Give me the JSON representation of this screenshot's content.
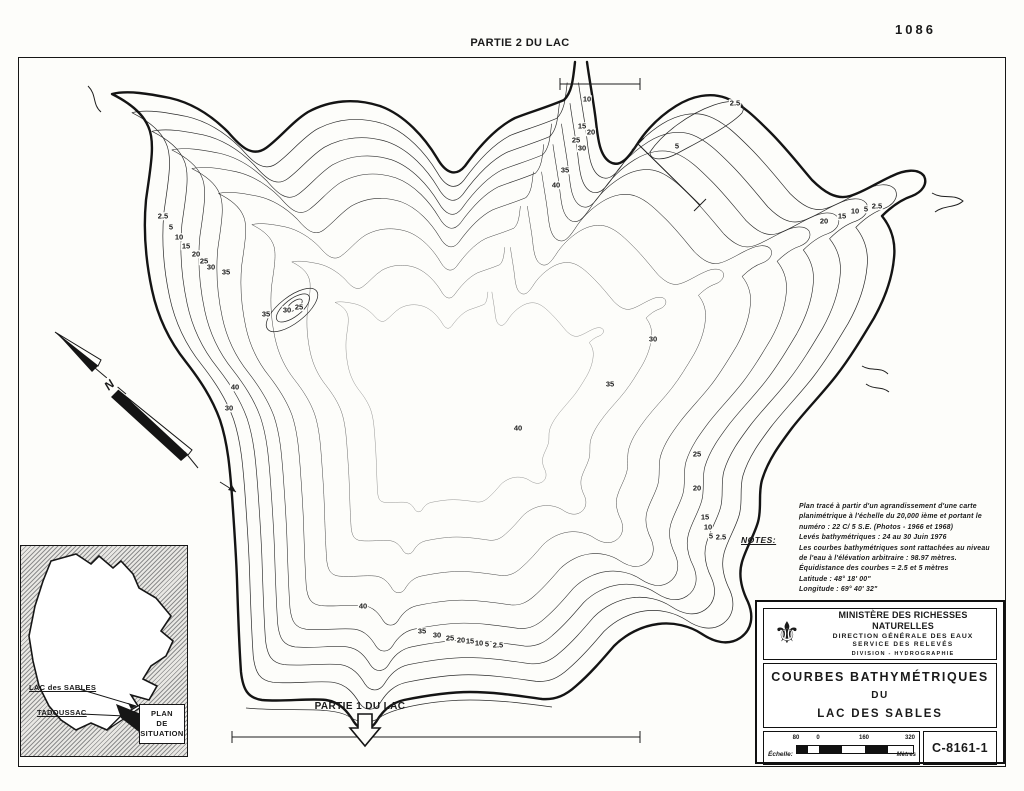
{
  "page": {
    "top_title": "PARTIE 2 DU LAC",
    "sheet_number": "1086"
  },
  "map": {
    "partie1_label": "PARTIE 1 DU LAC",
    "north_label": "N",
    "contour_labels": [
      {
        "x": 163,
        "y": 216,
        "v": "2.5"
      },
      {
        "x": 171,
        "y": 227,
        "v": "5"
      },
      {
        "x": 179,
        "y": 237,
        "v": "10"
      },
      {
        "x": 186,
        "y": 246,
        "v": "15"
      },
      {
        "x": 196,
        "y": 254,
        "v": "20"
      },
      {
        "x": 204,
        "y": 261,
        "v": "25"
      },
      {
        "x": 211,
        "y": 267,
        "v": "30"
      },
      {
        "x": 226,
        "y": 272,
        "v": "35"
      },
      {
        "x": 235,
        "y": 387,
        "v": "40"
      },
      {
        "x": 229,
        "y": 408,
        "v": "30"
      },
      {
        "x": 266,
        "y": 314,
        "v": "35"
      },
      {
        "x": 287,
        "y": 310,
        "v": "30"
      },
      {
        "x": 299,
        "y": 307,
        "v": "25"
      },
      {
        "x": 587,
        "y": 99,
        "v": "10"
      },
      {
        "x": 582,
        "y": 126,
        "v": "15"
      },
      {
        "x": 591,
        "y": 132,
        "v": "20"
      },
      {
        "x": 576,
        "y": 140,
        "v": "25"
      },
      {
        "x": 582,
        "y": 148,
        "v": "30"
      },
      {
        "x": 565,
        "y": 170,
        "v": "35"
      },
      {
        "x": 556,
        "y": 185,
        "v": "40"
      },
      {
        "x": 518,
        "y": 428,
        "v": "40"
      },
      {
        "x": 610,
        "y": 384,
        "v": "35"
      },
      {
        "x": 653,
        "y": 339,
        "v": "30"
      },
      {
        "x": 697,
        "y": 454,
        "v": "25"
      },
      {
        "x": 697,
        "y": 488,
        "v": "20"
      },
      {
        "x": 705,
        "y": 517,
        "v": "15"
      },
      {
        "x": 708,
        "y": 527,
        "v": "10"
      },
      {
        "x": 711,
        "y": 536,
        "v": "5"
      },
      {
        "x": 721,
        "y": 537,
        "v": "2.5"
      },
      {
        "x": 735,
        "y": 103,
        "v": "2.5"
      },
      {
        "x": 677,
        "y": 146,
        "v": "5"
      },
      {
        "x": 824,
        "y": 221,
        "v": "20"
      },
      {
        "x": 842,
        "y": 216,
        "v": "15"
      },
      {
        "x": 855,
        "y": 211,
        "v": "10"
      },
      {
        "x": 866,
        "y": 209,
        "v": "5"
      },
      {
        "x": 877,
        "y": 206,
        "v": "2.5"
      },
      {
        "x": 363,
        "y": 606,
        "v": "40"
      },
      {
        "x": 422,
        "y": 631,
        "v": "35"
      },
      {
        "x": 437,
        "y": 635,
        "v": "30"
      },
      {
        "x": 450,
        "y": 638,
        "v": "25"
      },
      {
        "x": 461,
        "y": 640,
        "v": "20"
      },
      {
        "x": 470,
        "y": 641,
        "v": "15"
      },
      {
        "x": 479,
        "y": 643,
        "v": "10"
      },
      {
        "x": 487,
        "y": 644,
        "v": "5"
      },
      {
        "x": 498,
        "y": 645,
        "v": "2.5"
      }
    ]
  },
  "notes": {
    "heading": "NOTES:",
    "lines": [
      "Plan tracé à partir d'un agrandissement d'une carte",
      "planimétrique  à  l'échelle du 20,000 ième et portant le",
      "numéro :  22 C/ 5   S.E.  (Photos - 1966 et 1968)",
      "Levés bathymétriques : 24 au 30 Juin 1976",
      "Les courbes bathymétriques sont rattachées au niveau",
      "de l'eau à l'élévation arbitraire :  98.97 mètres.",
      "Équidistance des courbes = 2.5 et 5 mètres",
      "Latitude  :  48° 18' 00\"",
      "Longitude : 69° 40' 32\""
    ]
  },
  "inset": {
    "lac_label": "LAC des SABLES",
    "town_label": "TADOUSSAC",
    "box_lines": [
      "PLAN",
      "DE",
      "SITUATION"
    ]
  },
  "title_block": {
    "fleur_icon": "⚜",
    "ministry": "MINISTÈRE DES RICHESSES NATURELLES",
    "direction": "DIRECTION GÉNÉRALE DES EAUX",
    "service": "SERVICE DES RELEVÉS",
    "division": "DIVISION - HYDROGRAPHIE",
    "title_line1": "COURBES BATHYMÉTRIQUES",
    "title_line2": "DU",
    "title_line3": "LAC DES SABLES",
    "drawing_number": "C-8161-1",
    "scale": {
      "label": "Échelle:",
      "ticks": [
        "80",
        "0",
        "160",
        "320"
      ],
      "unit": "Mètres"
    }
  },
  "colors": {
    "ink": "#161616",
    "paper": "#fdfdfa"
  }
}
